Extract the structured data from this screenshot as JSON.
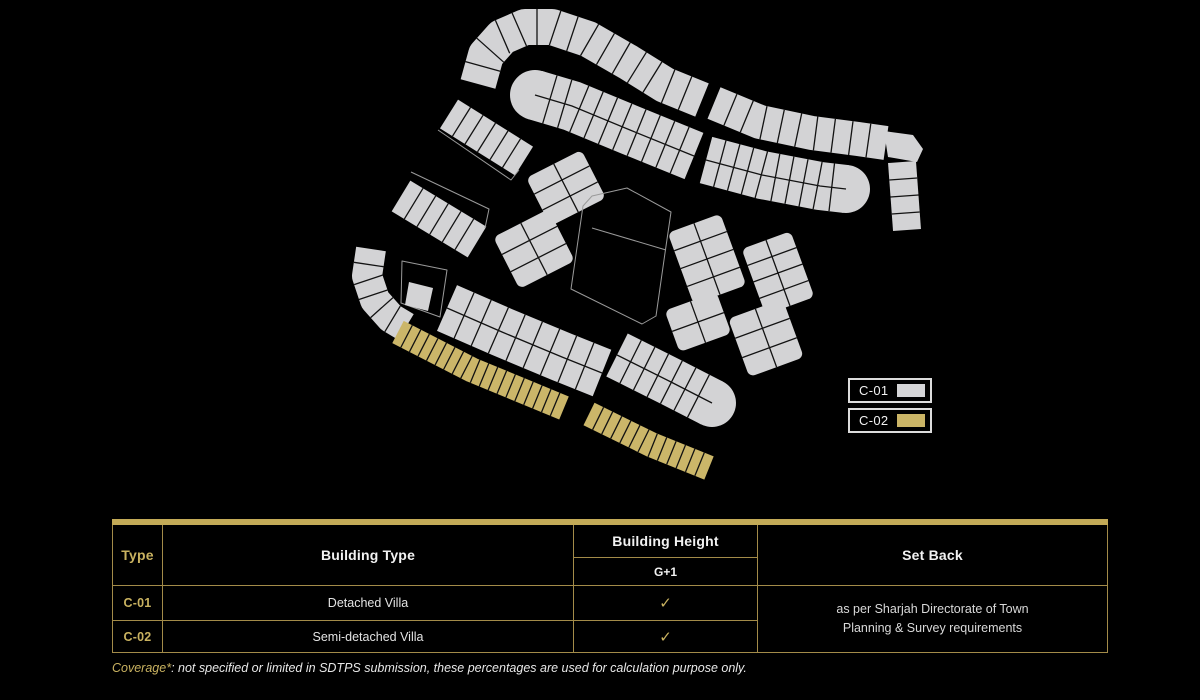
{
  "legend": {
    "items": [
      {
        "label": "C-01",
        "color": "#d5d5d7"
      },
      {
        "label": "C-02",
        "color": "#cbb566"
      }
    ]
  },
  "table": {
    "columns": {
      "type": "Type",
      "building_type": "Building Type",
      "building_height": "Building Height",
      "set_back": "Set Back"
    },
    "sub_header": "G+1",
    "rows": [
      {
        "type": "C-01",
        "building_type": "Detached Villa",
        "check": "✓"
      },
      {
        "type": "C-02",
        "building_type": "Semi-detached Villa",
        "check": "✓"
      }
    ],
    "set_back_note": "as per Sharjah Directorate of Town Planning & Survey requirements"
  },
  "footnote": {
    "prefix": "Coverage*",
    "text": ": not specified or limited in SDTPS submission, these percentages are used for calculation purpose only."
  },
  "site_plan": {
    "colors": {
      "plot": "#d3d3d5",
      "highlight": "#cbb669",
      "line": "#121212",
      "outline": "#9a9a9a"
    },
    "bands": [
      {
        "name": "top-row-west",
        "pts": [
          [
            478,
            84
          ],
          [
            486,
            55
          ],
          [
            502,
            37
          ],
          [
            525,
            27
          ],
          [
            552,
            27
          ],
          [
            588,
            39
          ],
          [
            628,
            62
          ],
          [
            665,
            85
          ],
          [
            702,
            100
          ]
        ],
        "w": 36,
        "plots": 15,
        "fill": "plot"
      },
      {
        "name": "top-row-east",
        "pts": [
          [
            714,
            103
          ],
          [
            760,
            122
          ],
          [
            812,
            133
          ],
          [
            858,
            139
          ],
          [
            886,
            143
          ]
        ],
        "w": 34,
        "plots": 10,
        "fill": "plot"
      },
      {
        "name": "second-row-west",
        "pts": [
          [
            535,
            95
          ],
          [
            572,
            106
          ],
          [
            630,
            130
          ],
          [
            694,
            156
          ]
        ],
        "w": 50,
        "plots": 11,
        "rows": 2,
        "fill": "plot",
        "round_start": true
      },
      {
        "name": "second-row-east",
        "pts": [
          [
            706,
            160
          ],
          [
            762,
            175
          ],
          [
            820,
            186
          ],
          [
            846,
            189
          ]
        ],
        "w": 48,
        "plots": 10,
        "rows": 2,
        "fill": "plot",
        "round_end": true
      },
      {
        "name": "east-strip",
        "pts": [
          [
            902,
            162
          ],
          [
            907,
            230
          ]
        ],
        "w": 28,
        "plots": 4,
        "fill": "plot"
      },
      {
        "name": "west-strip-1",
        "pts": [
          [
            449,
            114
          ],
          [
            524,
            161
          ]
        ],
        "w": 34,
        "plots": 6,
        "fill": "plot"
      },
      {
        "name": "west-strip-2",
        "pts": [
          [
            401,
            196
          ],
          [
            477,
            242
          ]
        ],
        "w": 36,
        "plots": 6,
        "fill": "plot"
      },
      {
        "name": "west-hook",
        "pts": [
          [
            371,
            249
          ],
          [
            367,
            276
          ],
          [
            375,
            300
          ],
          [
            391,
            318
          ],
          [
            406,
            327
          ]
        ],
        "w": 30,
        "plots": 6,
        "fill": "plot"
      },
      {
        "name": "lower-row-west",
        "pts": [
          [
            447,
            308
          ],
          [
            502,
            332
          ],
          [
            562,
            357
          ],
          [
            602,
            373
          ]
        ],
        "w": 50,
        "plots": 9,
        "rows": 2,
        "fill": "plot"
      },
      {
        "name": "lower-row-east",
        "pts": [
          [
            617,
            355
          ],
          [
            671,
            382
          ],
          [
            712,
            403
          ]
        ],
        "w": 48,
        "plots": 7,
        "rows": 2,
        "fill": "plot",
        "round_end": true
      },
      {
        "name": "gold-row-west",
        "pts": [
          [
            398,
            332
          ],
          [
            472,
            370
          ],
          [
            564,
            408
          ]
        ],
        "w": 25,
        "plots": 19,
        "fill": "highlight"
      },
      {
        "name": "gold-row-east",
        "pts": [
          [
            589,
            414
          ],
          [
            652,
            445
          ],
          [
            709,
            468
          ]
        ],
        "w": 25,
        "plots": 13,
        "fill": "highlight"
      }
    ],
    "blocks": [
      {
        "name": "nw-1",
        "cx": 566,
        "cy": 188,
        "w": 62,
        "h": 54,
        "cols": 2,
        "rows": 3,
        "angle": -27
      },
      {
        "name": "nw-2",
        "cx": 534,
        "cy": 249,
        "w": 62,
        "h": 58,
        "cols": 2,
        "rows": 3,
        "angle": -27
      },
      {
        "name": "ne-1",
        "cx": 707,
        "cy": 259,
        "w": 56,
        "h": 76,
        "cols": 2,
        "rows": 4,
        "angle": -20
      },
      {
        "name": "ne-2",
        "cx": 778,
        "cy": 273,
        "w": 52,
        "h": 70,
        "cols": 2,
        "rows": 4,
        "angle": -20
      },
      {
        "name": "se-1",
        "cx": 698,
        "cy": 322,
        "w": 55,
        "h": 44,
        "cols": 2,
        "rows": 2,
        "angle": -20
      },
      {
        "name": "se-2",
        "cx": 766,
        "cy": 338,
        "w": 58,
        "h": 62,
        "cols": 2,
        "rows": 3,
        "angle": -20
      }
    ],
    "polygons": [
      {
        "name": "corner-plot",
        "pts": [
          [
            884,
            131
          ],
          [
            913,
            135
          ],
          [
            923,
            149
          ],
          [
            917,
            162
          ],
          [
            888,
            157
          ]
        ],
        "fill": "plot"
      },
      {
        "name": "central-plot",
        "pts": [
          [
            592,
            196
          ],
          [
            627,
            188
          ],
          [
            671,
            212
          ],
          [
            665,
            253
          ],
          [
            656,
            316
          ],
          [
            642,
            324
          ],
          [
            571,
            289
          ],
          [
            583,
            206
          ]
        ],
        "stroke": "outline",
        "split": [
          [
            592,
            228
          ],
          [
            666,
            250
          ]
        ]
      },
      {
        "name": "ghost-outline-1",
        "pts": [
          [
            438,
            130
          ],
          [
            511,
            180
          ],
          [
            519,
            170
          ]
        ],
        "stroke": "outline",
        "open": true
      },
      {
        "name": "ghost-outline-2",
        "pts": [
          [
            411,
            172
          ],
          [
            489,
            209
          ],
          [
            485,
            228
          ]
        ],
        "stroke": "outline",
        "open": true
      },
      {
        "name": "ghost-outline-3",
        "pts": [
          [
            402,
            261
          ],
          [
            447,
            270
          ],
          [
            440,
            317
          ],
          [
            401,
            303
          ]
        ],
        "stroke": "outline"
      },
      {
        "name": "ghost-plot",
        "pts": [
          [
            409,
            282
          ],
          [
            433,
            288
          ],
          [
            428,
            311
          ],
          [
            405,
            305
          ]
        ],
        "fill": "plot"
      }
    ]
  }
}
